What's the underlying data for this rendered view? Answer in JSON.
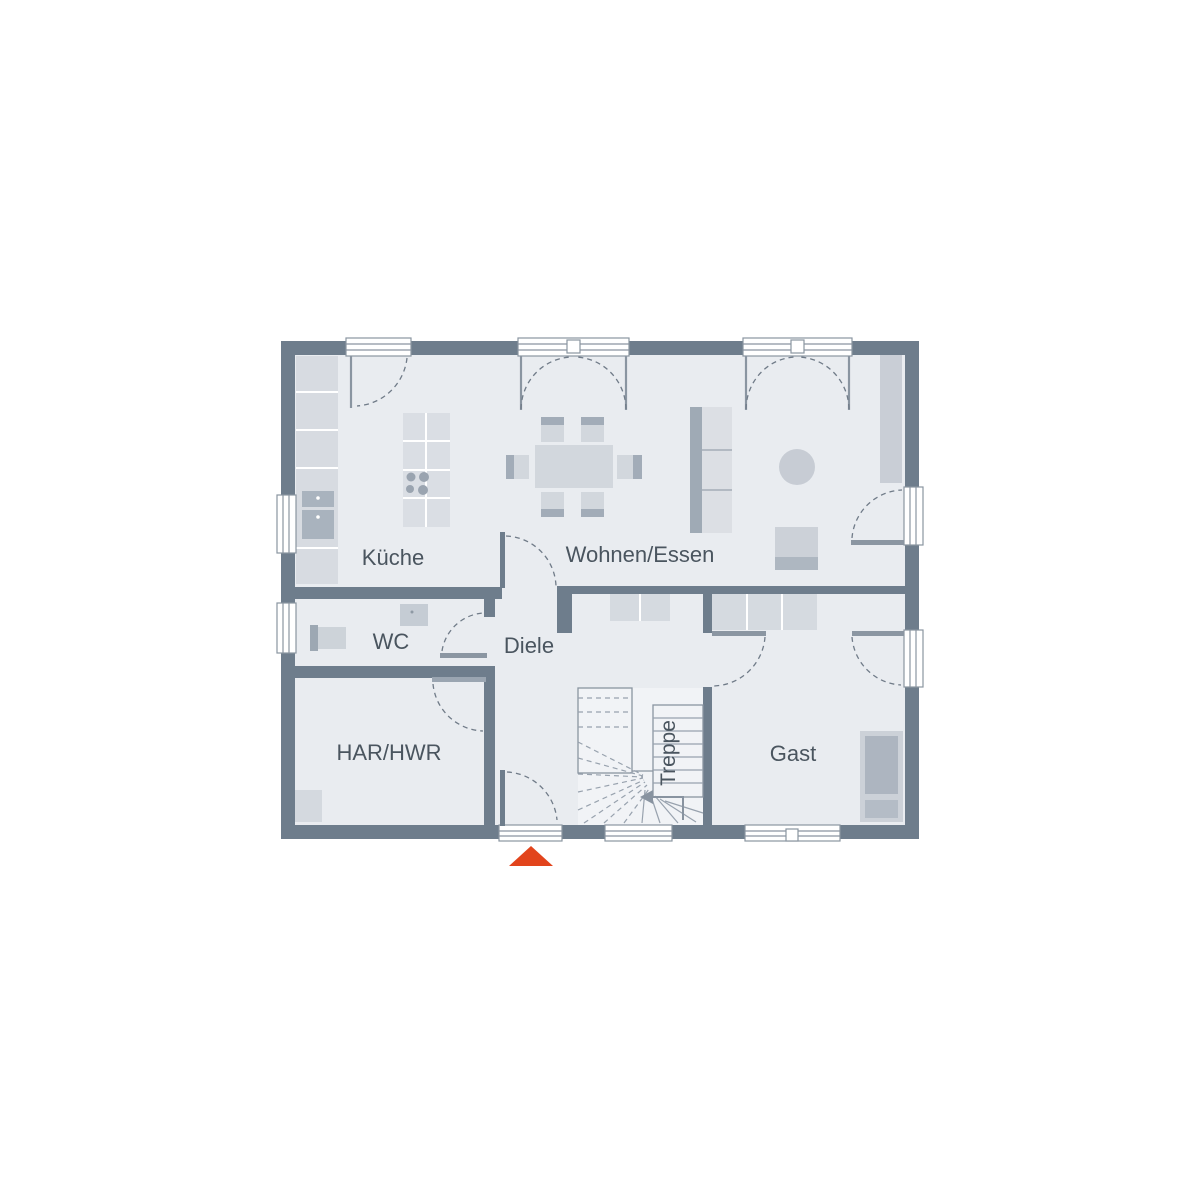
{
  "floor_plan": {
    "rooms": {
      "kueche": {
        "label": "Küche"
      },
      "wohnen_essen": {
        "label": "Wohnen/Essen"
      },
      "wc": {
        "label": "WC"
      },
      "diele": {
        "label": "Diele"
      },
      "har_hwr": {
        "label": "HAR/HWR"
      },
      "gast": {
        "label": "Gast"
      },
      "treppe": {
        "label": "Treppe"
      }
    },
    "colors": {
      "wall": "#6e7d8c",
      "floor": "#e9ecf0",
      "stair_floor": "#f1f3f6",
      "furniture_light": "#d6dae0",
      "furniture_medium": "#c7ccd4",
      "furniture_dark": "#a9b3be",
      "door_leaf": "#8b96a2",
      "outline": "#8a95a1",
      "label_text": "#4a555f",
      "entrance_accent": "#e2441c"
    },
    "markers": {
      "entrance": "entrance-arrow"
    }
  }
}
